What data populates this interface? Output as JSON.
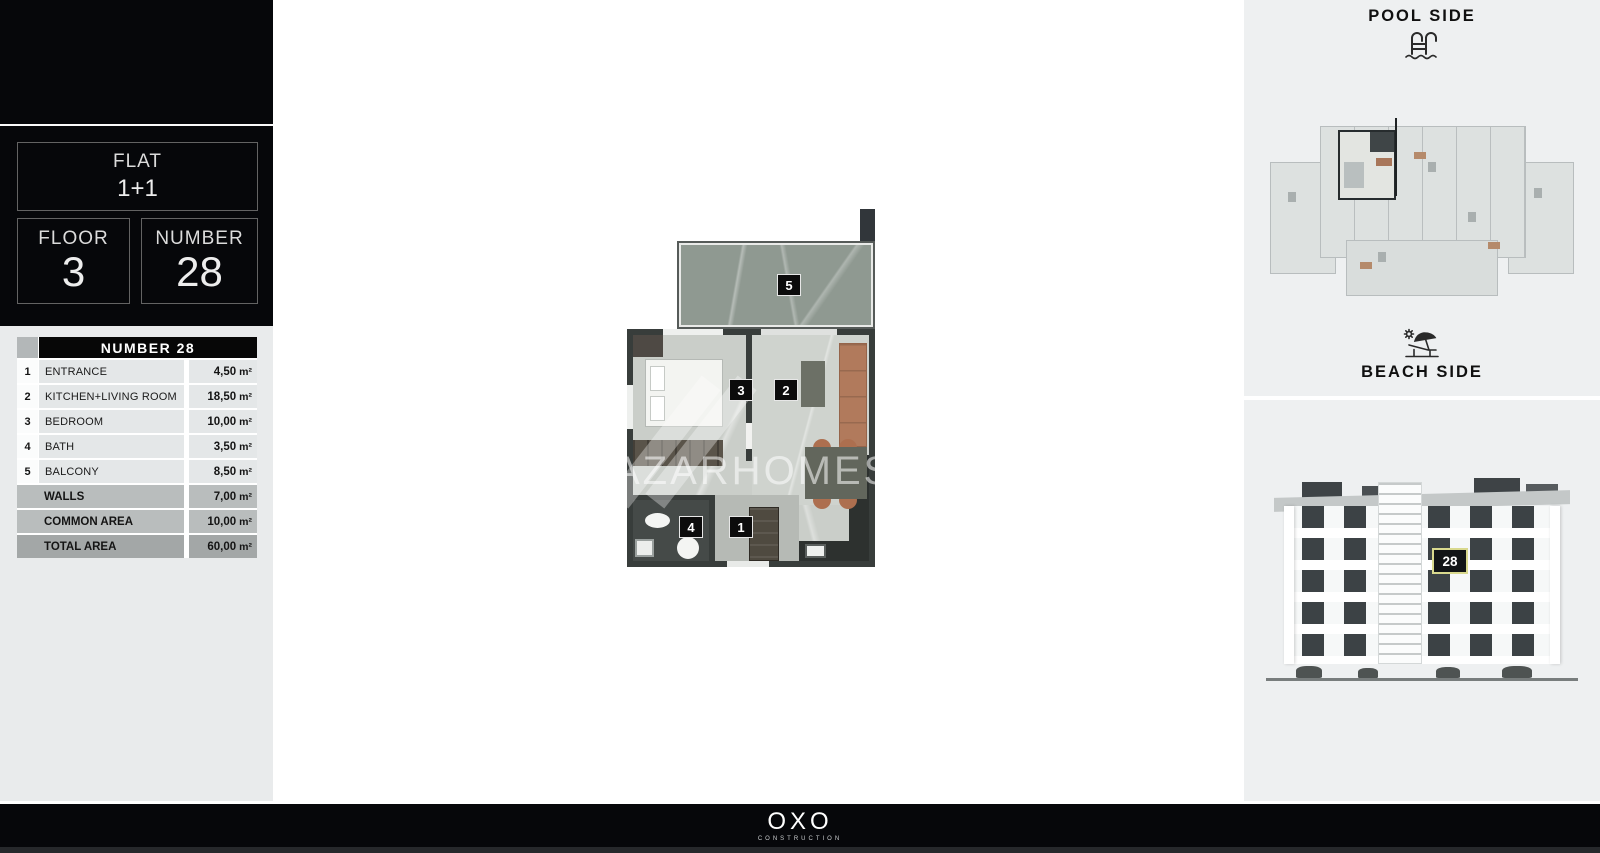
{
  "sidebar": {
    "flat": {
      "label": "FLAT",
      "value": "1+1"
    },
    "floor": {
      "label": "FLOOR",
      "value": "3"
    },
    "number": {
      "label": "NUMBER",
      "value": "28"
    },
    "table": {
      "header": "NUMBER 28",
      "unit": "m²",
      "rows": [
        {
          "num": "1",
          "label": "ENTRANCE",
          "value": "4,50"
        },
        {
          "num": "2",
          "label": "KITCHEN+LIVING ROOM",
          "value": "18,50"
        },
        {
          "num": "3",
          "label": "BEDROOM",
          "value": "10,00"
        },
        {
          "num": "4",
          "label": "BATH",
          "value": "3,50"
        },
        {
          "num": "5",
          "label": "BALCONY",
          "value": "8,50"
        }
      ],
      "summary": [
        {
          "label": "WALLS",
          "value": "7,00"
        },
        {
          "label": "COMMON AREA",
          "value": "10,00"
        },
        {
          "label": "TOTAL AREA",
          "value": "60,00"
        }
      ]
    }
  },
  "floorplan": {
    "watermark": "AZARHOMES",
    "labels": {
      "entrance": "1",
      "living": "2",
      "bedroom": "3",
      "bath": "4",
      "balcony": "5"
    }
  },
  "right_panel": {
    "pool_side_label": "POOL SIDE",
    "beach_side_label": "BEACH SIDE",
    "building_badge": "28"
  },
  "footer": {
    "brand": "OXO",
    "subtitle": "CONSTRUCTION"
  },
  "colors": {
    "sidebar_bg": "#e9ebec",
    "panel_bg": "#eef0f1",
    "black": "#06070a",
    "table_summary_bg": "#b9bdbd",
    "table_total_bg": "#a3a7a7",
    "badge_border": "#d9d98e",
    "balcony_floor": "#8f9991",
    "sofa_brown": "#b17a5c"
  }
}
